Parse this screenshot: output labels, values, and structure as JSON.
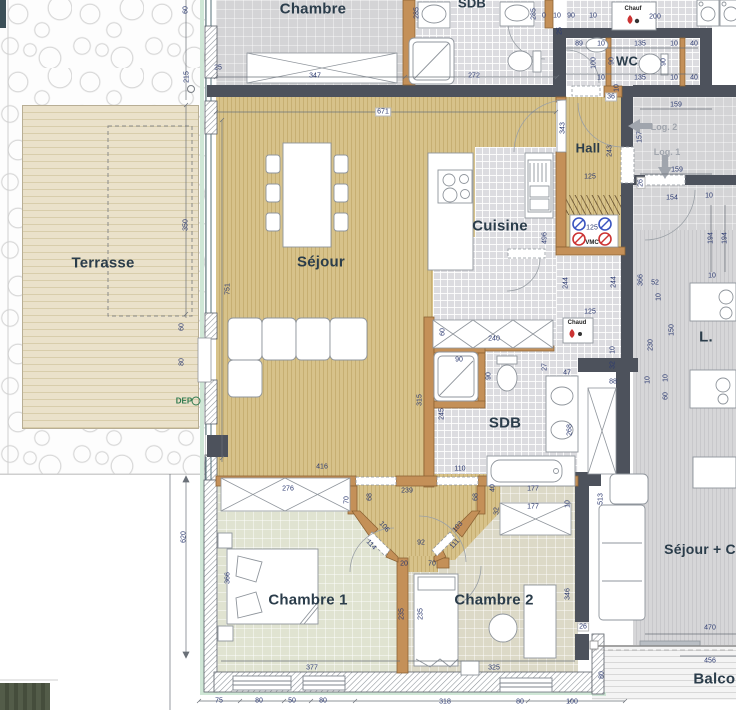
{
  "title": "Plan d'appartement",
  "rooms": [
    {
      "label": "Chambre",
      "x": 313,
      "y": 9,
      "fs": 15
    },
    {
      "label": "SDB",
      "x": 472,
      "y": 3,
      "fs": 13
    },
    {
      "label": "WC",
      "x": 627,
      "y": 61,
      "fs": 13
    },
    {
      "label": "Hall",
      "x": 588,
      "y": 148,
      "fs": 13
    },
    {
      "label": "Terrasse",
      "x": 103,
      "y": 263,
      "fs": 15
    },
    {
      "label": "Séjour",
      "x": 321,
      "y": 262,
      "fs": 15
    },
    {
      "label": "Cuisine",
      "x": 500,
      "y": 226,
      "fs": 15
    },
    {
      "label": "SDB",
      "x": 505,
      "y": 423,
      "fs": 15
    },
    {
      "label": "Chambre 1",
      "x": 308,
      "y": 600,
      "fs": 15
    },
    {
      "label": "Chambre 2",
      "x": 494,
      "y": 600,
      "fs": 15
    },
    {
      "label": "Séjour + C",
      "x": 700,
      "y": 549,
      "fs": 14
    },
    {
      "label": "Balcon",
      "x": 719,
      "y": 679,
      "fs": 15
    },
    {
      "label": "L.",
      "x": 706,
      "y": 337,
      "fs": 15
    }
  ],
  "annotations": [
    {
      "label": "Log. 2",
      "x": 664,
      "y": 127,
      "cls": "log"
    },
    {
      "label": "Log. 1",
      "x": 667,
      "y": 152,
      "cls": "log"
    },
    {
      "label": "DEP",
      "x": 184,
      "y": 401,
      "cls": "dep"
    },
    {
      "label": "Chauf",
      "x": 633,
      "y": 9,
      "cls": "unit"
    },
    {
      "label": "Chaud",
      "x": 577,
      "y": 323,
      "cls": "unit"
    },
    {
      "label": "VMC",
      "x": 592,
      "y": 243,
      "cls": "unit"
    }
  ],
  "dims": [
    {
      "t": "60",
      "x": 186,
      "y": 10,
      "r": -90
    },
    {
      "t": "215",
      "x": 187,
      "y": 77,
      "r": -90
    },
    {
      "t": "25",
      "x": 218,
      "y": 68
    },
    {
      "t": "350",
      "x": 186,
      "y": 225,
      "r": -90
    },
    {
      "t": "60",
      "x": 182,
      "y": 327,
      "r": -90
    },
    {
      "t": "80",
      "x": 182,
      "y": 362,
      "r": -90
    },
    {
      "t": "620",
      "x": 184,
      "y": 537,
      "r": -90
    },
    {
      "t": "347",
      "x": 315,
      "y": 76
    },
    {
      "t": "272",
      "x": 474,
      "y": 76
    },
    {
      "t": "285",
      "x": 417,
      "y": 13,
      "r": -90
    },
    {
      "t": "285",
      "x": 534,
      "y": 14,
      "r": -90
    },
    {
      "t": "0",
      "x": 544,
      "y": 16
    },
    {
      "t": "10",
      "x": 557,
      "y": 16
    },
    {
      "t": "90",
      "x": 571,
      "y": 16
    },
    {
      "t": "10",
      "x": 593,
      "y": 16
    },
    {
      "t": "200",
      "x": 655,
      "y": 17
    },
    {
      "t": "25",
      "x": 560,
      "y": 31,
      "r": -90
    },
    {
      "t": "89",
      "x": 579,
      "y": 44
    },
    {
      "t": "10",
      "x": 601,
      "y": 44
    },
    {
      "t": "135",
      "x": 640,
      "y": 44
    },
    {
      "t": "10",
      "x": 674,
      "y": 44
    },
    {
      "t": "40",
      "x": 694,
      "y": 44
    },
    {
      "t": "100",
      "x": 594,
      "y": 63,
      "r": -90
    },
    {
      "t": "90",
      "x": 612,
      "y": 61,
      "r": -90
    },
    {
      "t": "90",
      "x": 664,
      "y": 62,
      "r": -90
    },
    {
      "t": "10",
      "x": 601,
      "y": 78
    },
    {
      "t": "135",
      "x": 640,
      "y": 78
    },
    {
      "t": "10",
      "x": 674,
      "y": 78
    },
    {
      "t": "40",
      "x": 694,
      "y": 78
    },
    {
      "t": "36",
      "x": 611,
      "y": 97,
      "b": 1
    },
    {
      "t": "10",
      "x": 617,
      "y": 88,
      "r": -90
    },
    {
      "t": "159",
      "x": 676,
      "y": 105
    },
    {
      "t": "157",
      "x": 640,
      "y": 137,
      "r": -90
    },
    {
      "t": "159",
      "x": 677,
      "y": 170
    },
    {
      "t": "26",
      "x": 641,
      "y": 183,
      "r": -90,
      "b": 1
    },
    {
      "t": "154",
      "x": 672,
      "y": 198
    },
    {
      "t": "10",
      "x": 709,
      "y": 196
    },
    {
      "t": "194",
      "x": 711,
      "y": 238,
      "r": -90
    },
    {
      "t": "194",
      "x": 725,
      "y": 238,
      "r": -90
    },
    {
      "t": "10",
      "x": 712,
      "y": 276
    },
    {
      "t": "52",
      "x": 655,
      "y": 283
    },
    {
      "t": "10",
      "x": 659,
      "y": 297,
      "r": -90
    },
    {
      "t": "150",
      "x": 672,
      "y": 330,
      "r": -90
    },
    {
      "t": "230",
      "x": 651,
      "y": 345,
      "r": -90
    },
    {
      "t": "10",
      "x": 648,
      "y": 380,
      "r": -90
    },
    {
      "t": "10",
      "x": 666,
      "y": 378,
      "r": -90
    },
    {
      "t": "60",
      "x": 666,
      "y": 396,
      "r": -90
    },
    {
      "t": "671",
      "x": 383,
      "y": 112,
      "b": 1
    },
    {
      "t": "751",
      "x": 228,
      "y": 289,
      "r": -90
    },
    {
      "t": "343",
      "x": 563,
      "y": 128,
      "r": -90
    },
    {
      "t": "243",
      "x": 610,
      "y": 151,
      "r": -90
    },
    {
      "t": "125",
      "x": 590,
      "y": 177
    },
    {
      "t": "496",
      "x": 545,
      "y": 238,
      "r": -90
    },
    {
      "t": "125",
      "x": 592,
      "y": 228
    },
    {
      "t": "244",
      "x": 566,
      "y": 283,
      "r": -90
    },
    {
      "t": "244",
      "x": 614,
      "y": 282,
      "r": -90
    },
    {
      "t": "366",
      "x": 641,
      "y": 280,
      "r": -90
    },
    {
      "t": "125",
      "x": 590,
      "y": 312
    },
    {
      "t": "240",
      "x": 494,
      "y": 339
    },
    {
      "t": "60",
      "x": 443,
      "y": 332,
      "r": -90
    },
    {
      "t": "10",
      "x": 613,
      "y": 350,
      "r": -90
    },
    {
      "t": "32",
      "x": 613,
      "y": 365,
      "r": -90
    },
    {
      "t": "90",
      "x": 459,
      "y": 360
    },
    {
      "t": "90",
      "x": 489,
      "y": 376,
      "r": -90
    },
    {
      "t": "27",
      "x": 545,
      "y": 367,
      "r": -90
    },
    {
      "t": "47",
      "x": 567,
      "y": 373
    },
    {
      "t": "88",
      "x": 613,
      "y": 382
    },
    {
      "t": "315",
      "x": 420,
      "y": 400,
      "r": -90
    },
    {
      "t": "245",
      "x": 442,
      "y": 414,
      "r": -90
    },
    {
      "t": "268",
      "x": 570,
      "y": 430,
      "r": -90
    },
    {
      "t": "110",
      "x": 460,
      "y": 469
    },
    {
      "t": "416",
      "x": 322,
      "y": 467
    },
    {
      "t": "177",
      "x": 533,
      "y": 489
    },
    {
      "t": "177",
      "x": 533,
      "y": 507
    },
    {
      "t": "40",
      "x": 493,
      "y": 488,
      "r": -90
    },
    {
      "t": "10",
      "x": 568,
      "y": 504,
      "r": -90
    },
    {
      "t": "276",
      "x": 288,
      "y": 489
    },
    {
      "t": "70",
      "x": 347,
      "y": 500,
      "r": -90
    },
    {
      "t": "239",
      "x": 407,
      "y": 491
    },
    {
      "t": "68",
      "x": 370,
      "y": 497,
      "r": -90
    },
    {
      "t": "68",
      "x": 476,
      "y": 497,
      "r": -90
    },
    {
      "t": "32",
      "x": 497,
      "y": 511,
      "r": -90
    },
    {
      "t": "106",
      "x": 384,
      "y": 527,
      "r": 48
    },
    {
      "t": "103",
      "x": 458,
      "y": 527,
      "r": -48
    },
    {
      "t": "114",
      "x": 371,
      "y": 545,
      "r": 48
    },
    {
      "t": "111",
      "x": 455,
      "y": 544,
      "r": -48
    },
    {
      "t": "92",
      "x": 421,
      "y": 543
    },
    {
      "t": "20",
      "x": 404,
      "y": 564
    },
    {
      "t": "70",
      "x": 432,
      "y": 564
    },
    {
      "t": "366",
      "x": 228,
      "y": 578,
      "r": -90
    },
    {
      "t": "377",
      "x": 312,
      "y": 668
    },
    {
      "t": "235",
      "x": 402,
      "y": 614,
      "r": -90
    },
    {
      "t": "235",
      "x": 421,
      "y": 614,
      "r": -90
    },
    {
      "t": "325",
      "x": 494,
      "y": 668
    },
    {
      "t": "346",
      "x": 568,
      "y": 594,
      "r": -90
    },
    {
      "t": "26",
      "x": 583,
      "y": 627,
      "b": 1
    },
    {
      "t": "513",
      "x": 601,
      "y": 499,
      "r": -90
    },
    {
      "t": "75",
      "x": 219,
      "y": 701
    },
    {
      "t": "80",
      "x": 259,
      "y": 701
    },
    {
      "t": "50",
      "x": 292,
      "y": 701
    },
    {
      "t": "80",
      "x": 323,
      "y": 701
    },
    {
      "t": "318",
      "x": 445,
      "y": 702
    },
    {
      "t": "80",
      "x": 520,
      "y": 702
    },
    {
      "t": "100",
      "x": 572,
      "y": 702
    },
    {
      "t": "470",
      "x": 710,
      "y": 628
    },
    {
      "t": "456",
      "x": 710,
      "y": 661
    },
    {
      "t": "80",
      "x": 602,
      "y": 675,
      "r": -90
    }
  ],
  "colors": {
    "wall": "#4d525c",
    "partition": "#c49058",
    "wood_floor": "#d7c28a",
    "deck": "#eae1ca",
    "tile": "#dcdce0",
    "dim_text": "#2c3a70",
    "room_text": "#2b3d4b",
    "vmc_red": "#cc3333",
    "vmc_blue": "#3a55c0",
    "log_grey": "#a0a5ad",
    "dep_green": "#2f7a4f",
    "pale_green": "#cfe7d6"
  }
}
